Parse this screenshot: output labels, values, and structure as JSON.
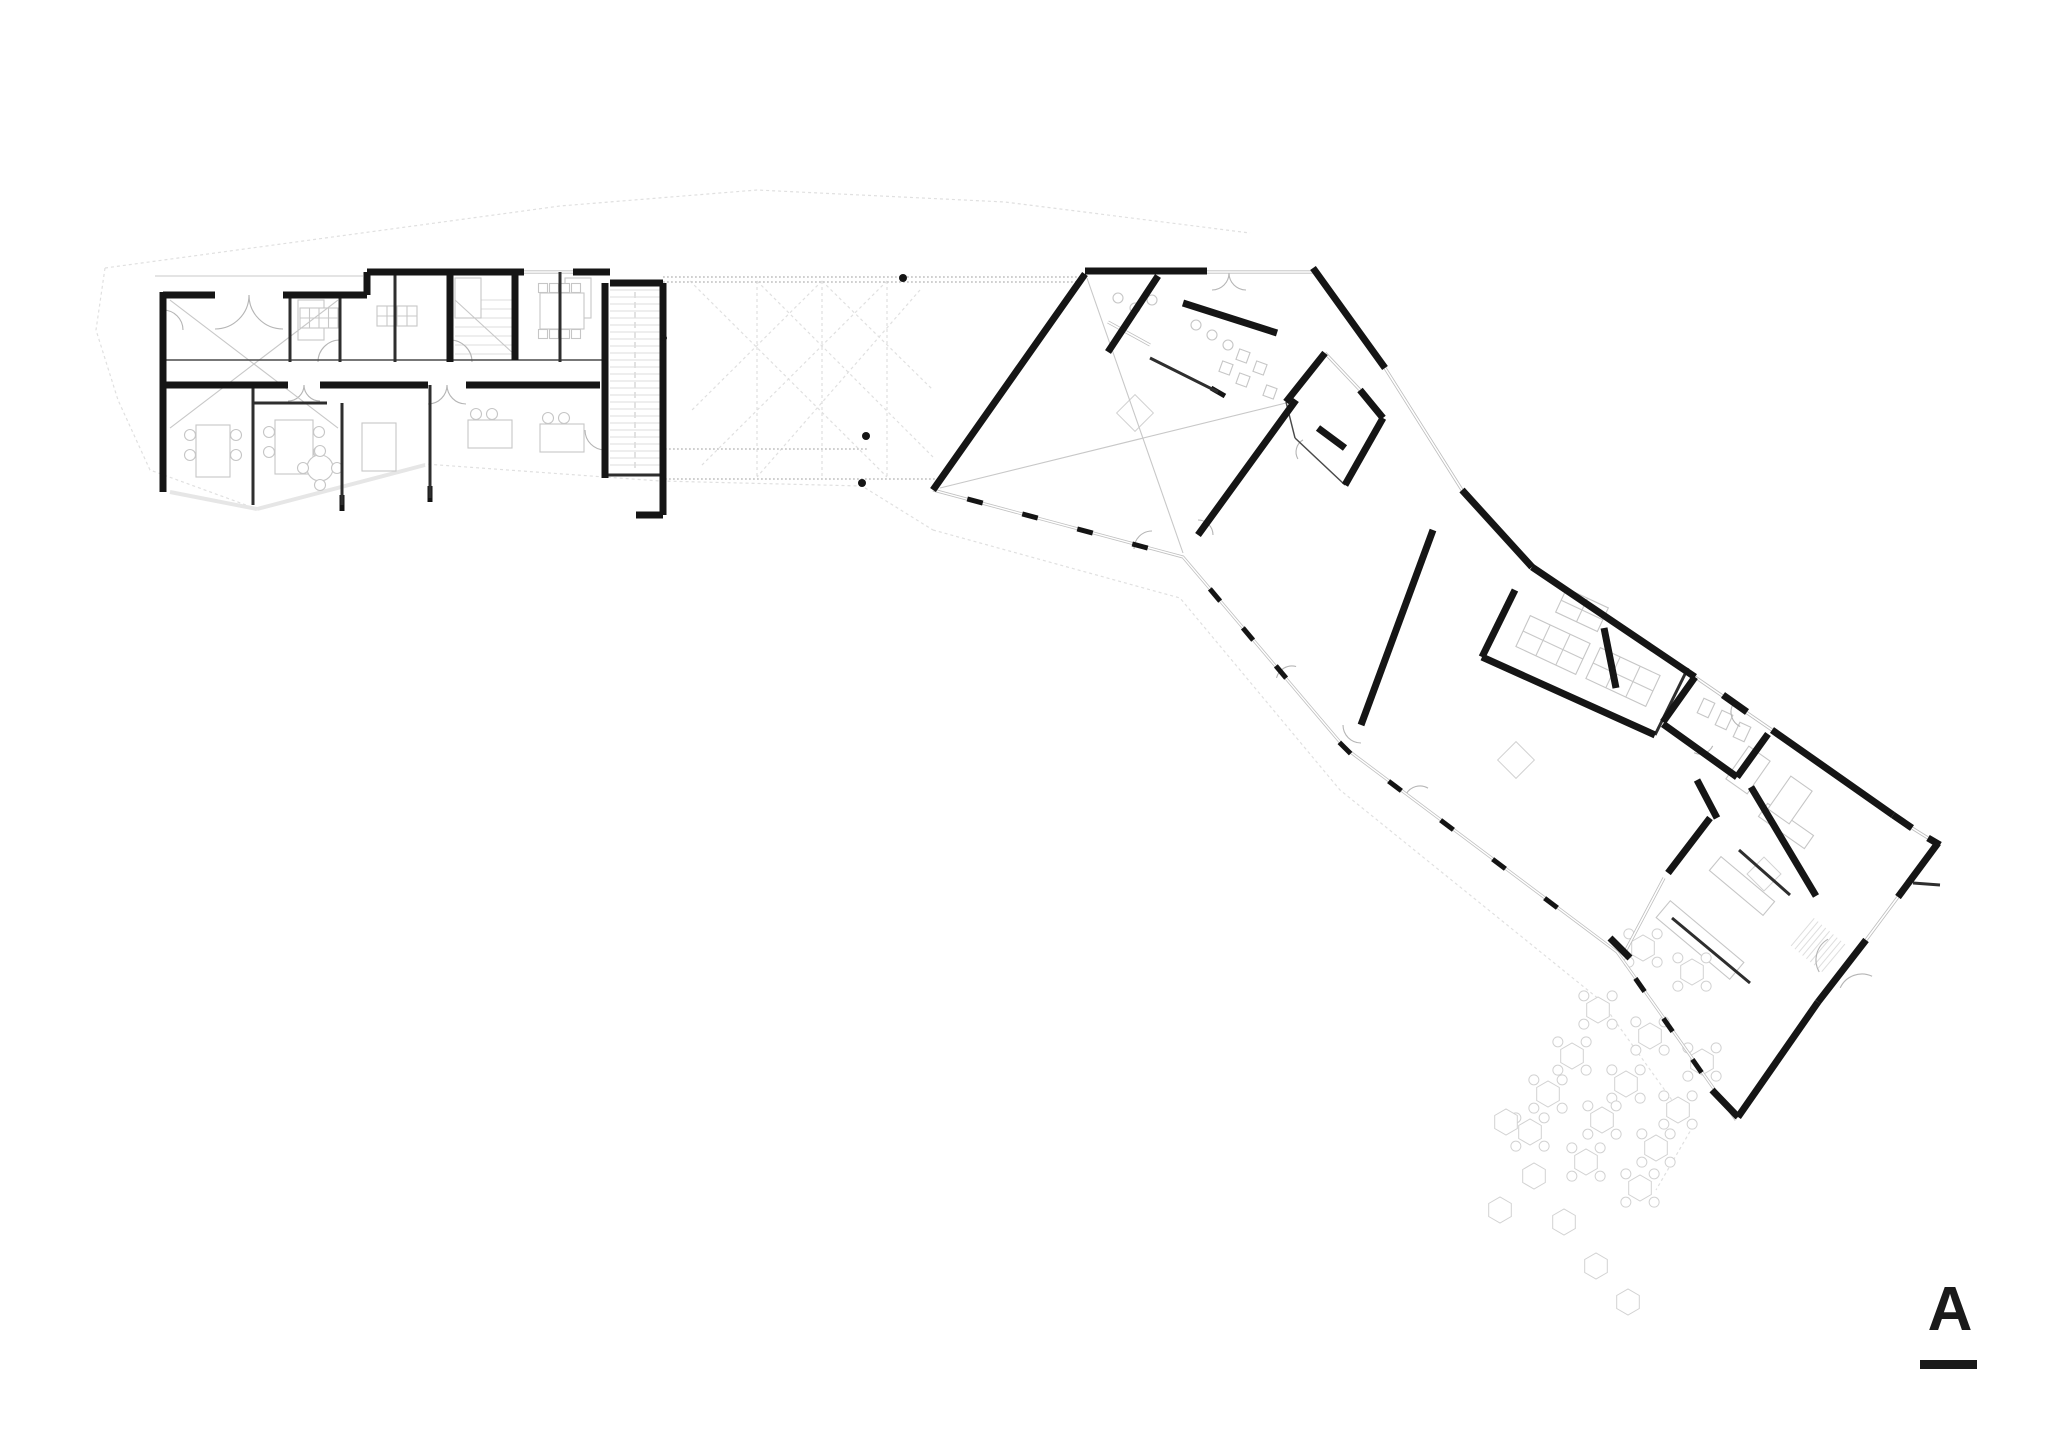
{
  "meta": {
    "type": "architectural-floor-plan",
    "sheet": "ground-floor-plan"
  },
  "marker": {
    "label": "A"
  },
  "palette": {
    "wall": "#151515",
    "medium": "#2e2e2e",
    "light": "#c8c8c8",
    "glass": "#bdbdbd",
    "marker": "#1a1a1a"
  },
  "plan": {
    "thick": [
      [
        163,
        295,
        215,
        295
      ],
      [
        283,
        295,
        367,
        295
      ],
      [
        367,
        272,
        367,
        295
      ],
      [
        367,
        272,
        524,
        272
      ],
      [
        573,
        272,
        610,
        272
      ],
      [
        610,
        283,
        663,
        283
      ],
      [
        163,
        292,
        163,
        492
      ],
      [
        163,
        385,
        288,
        385
      ],
      [
        320,
        385,
        428,
        385
      ],
      [
        466,
        385,
        600,
        385
      ],
      [
        605,
        283,
        605,
        478
      ],
      [
        663,
        283,
        663,
        515
      ],
      [
        663,
        515,
        636,
        515
      ],
      [
        515,
        272,
        515,
        360
      ],
      [
        450,
        272,
        450,
        362
      ],
      [
        1085,
        271,
        1207,
        271
      ],
      [
        1085,
        274,
        933,
        490
      ],
      [
        1313,
        268,
        1385,
        368
      ],
      [
        1462,
        490,
        1532,
        567
      ],
      [
        1532,
        567,
        1695,
        677
      ],
      [
        1695,
        677,
        1663,
        722
      ],
      [
        1158,
        276,
        1108,
        352
      ],
      [
        1183,
        303,
        1277,
        333
      ],
      [
        1296,
        400,
        1198,
        535
      ],
      [
        1433,
        530,
        1361,
        725
      ],
      [
        1325,
        353,
        1286,
        402
      ],
      [
        1360,
        390,
        1383,
        418
      ],
      [
        1383,
        418,
        1345,
        485
      ],
      [
        1318,
        428,
        1345,
        448
      ],
      [
        1610,
        938,
        1630,
        958
      ],
      [
        1482,
        657,
        1515,
        590
      ],
      [
        1482,
        657,
        1655,
        735
      ],
      [
        1604,
        628,
        1616,
        688
      ],
      [
        1663,
        724,
        1737,
        777
      ],
      [
        1737,
        777,
        1768,
        734
      ],
      [
        1772,
        730,
        1893,
        815
      ],
      [
        1723,
        695,
        1747,
        712
      ],
      [
        1893,
        815,
        1912,
        828
      ],
      [
        1928,
        838,
        1940,
        845
      ],
      [
        1938,
        843,
        1898,
        897
      ],
      [
        1866,
        940,
        1818,
        1002
      ],
      [
        1818,
        1002,
        1738,
        1117
      ],
      [
        1738,
        1117,
        1712,
        1090
      ],
      [
        1710,
        818,
        1668,
        873
      ],
      [
        1751,
        787,
        1816,
        896
      ],
      [
        1697,
        780,
        1717,
        818
      ]
    ],
    "medium": [
      [
        290,
        295,
        290,
        362
      ],
      [
        340,
        295,
        340,
        362
      ],
      [
        395,
        272,
        395,
        362
      ],
      [
        560,
        272,
        560,
        362
      ],
      [
        253,
        385,
        253,
        505
      ],
      [
        342,
        403,
        342,
        505
      ],
      [
        430,
        385,
        430,
        498
      ],
      [
        253,
        403,
        327,
        403
      ],
      [
        605,
        475,
        663,
        475
      ],
      [
        1150,
        358,
        1218,
        392
      ],
      [
        1655,
        735,
        1688,
        668
      ],
      [
        1672,
        918,
        1750,
        983
      ],
      [
        1913,
        883,
        1940,
        885
      ],
      [
        1739,
        850,
        1790,
        895
      ]
    ],
    "thin": [
      [
        1345,
        485,
        1295,
        438
      ],
      [
        1295,
        438,
        1286,
        402
      ],
      [
        163,
        360,
        605,
        360
      ]
    ],
    "light": [
      [
        170,
        300,
        338,
        428
      ],
      [
        338,
        300,
        170,
        428
      ],
      [
        940,
        488,
        1290,
        402
      ],
      [
        1087,
        278,
        1183,
        553
      ],
      [
        155,
        276,
        363,
        276
      ],
      [
        455,
        300,
        515,
        355
      ]
    ],
    "light3": [
      [
        170,
        492,
        257,
        509
      ],
      [
        257,
        509,
        425,
        465
      ]
    ],
    "dotband": [
      [
        663,
        277,
        1083,
        277
      ],
      [
        663,
        282,
        1083,
        282
      ],
      [
        665,
        449,
        868,
        449
      ],
      [
        665,
        479,
        935,
        479
      ]
    ],
    "dashpoly": [
      [
        [
          105,
          268
        ],
        [
          560,
          206
        ],
        [
          757,
          190
        ],
        [
          1005,
          202
        ],
        [
          1250,
          233
        ]
      ],
      [
        [
          105,
          268
        ],
        [
          96,
          330
        ],
        [
          118,
          400
        ],
        [
          150,
          470
        ],
        [
          257,
          509
        ],
        [
          425,
          464
        ],
        [
          660,
          481
        ],
        [
          862,
          486
        ],
        [
          933,
          530
        ]
      ],
      [
        [
          933,
          530
        ],
        [
          1180,
          598
        ],
        [
          1340,
          790
        ],
        [
          1600,
          1000
        ],
        [
          1692,
          1128
        ],
        [
          1656,
          1190
        ]
      ]
    ],
    "dashseg": [
      [
        757,
        281,
        757,
        477
      ],
      [
        822,
        281,
        822,
        477
      ],
      [
        887,
        281,
        887,
        477
      ],
      [
        690,
        281,
        887,
        477
      ],
      [
        757,
        281,
        933,
        457
      ],
      [
        822,
        281,
        933,
        390
      ],
      [
        822,
        281,
        690,
        412
      ],
      [
        887,
        281,
        700,
        467
      ],
      [
        920,
        290,
        757,
        477
      ]
    ],
    "cdash": [
      [
        635,
        292,
        635,
        468
      ]
    ],
    "glass": [
      [
        524,
        272,
        573,
        272
      ],
      [
        1207,
        272,
        1313,
        272
      ],
      [
        1385,
        368,
        1462,
        490
      ],
      [
        1695,
        677,
        1772,
        730
      ],
      [
        1898,
        897,
        1866,
        940
      ],
      [
        1912,
        828,
        1928,
        838
      ],
      [
        1664,
        878,
        1626,
        950
      ],
      [
        1108,
        322,
        1150,
        345
      ],
      [
        1325,
        353,
        1360,
        390
      ]
    ],
    "facade": {
      "pts": [
        [
          933,
          490
        ],
        [
          1183,
          557
        ],
        [
          1345,
          748
        ],
        [
          1617,
          952
        ],
        [
          1736,
          1120
        ]
      ]
    },
    "ticks": [
      [
        975,
        501,
        15
      ],
      [
        1030,
        516,
        15
      ],
      [
        1085,
        531,
        15
      ],
      [
        1140,
        546,
        15
      ],
      [
        1215,
        595,
        50
      ],
      [
        1248,
        634,
        50
      ],
      [
        1281,
        672,
        50
      ],
      [
        1345,
        748,
        45
      ],
      [
        1395,
        786,
        37
      ],
      [
        1447,
        825,
        37
      ],
      [
        1499,
        864,
        37
      ],
      [
        1551,
        903,
        37
      ],
      [
        1640,
        985,
        55
      ],
      [
        1668,
        1025,
        55
      ],
      [
        1697,
        1066,
        55
      ],
      [
        1218,
        392,
        30
      ],
      [
        342,
        503,
        90
      ],
      [
        430,
        494,
        90
      ]
    ],
    "dots": [
      [
        903,
        278,
        4
      ],
      [
        866,
        436,
        4
      ],
      [
        862,
        483,
        4
      ],
      [
        664,
        338,
        3
      ]
    ],
    "arcs": [
      [
        215,
        295,
        34,
        0,
        90
      ],
      [
        283,
        295,
        34,
        90,
        180
      ],
      [
        288,
        385,
        16,
        0,
        90
      ],
      [
        320,
        385,
        16,
        90,
        180
      ],
      [
        428,
        385,
        19,
        0,
        90
      ],
      [
        466,
        385,
        19,
        90,
        180
      ],
      [
        340,
        362,
        22,
        180,
        270
      ],
      [
        450,
        362,
        22,
        270,
        360
      ],
      [
        163,
        330,
        20,
        270,
        360
      ],
      [
        605,
        430,
        20,
        90,
        180
      ],
      [
        1212,
        273,
        17,
        0,
        90
      ],
      [
        1246,
        273,
        17,
        90,
        180
      ],
      [
        1361,
        725,
        18,
        90,
        180
      ],
      [
        1198,
        535,
        15,
        270,
        360
      ],
      [
        1152,
        549,
        18,
        180,
        270
      ],
      [
        1292,
        682,
        16,
        195,
        285
      ],
      [
        1420,
        802,
        16,
        210,
        300
      ],
      [
        1747,
        712,
        16,
        115,
        205
      ],
      [
        1840,
        960,
        24,
        150,
        240
      ],
      [
        1862,
        998,
        24,
        205,
        295
      ],
      [
        1310,
        452,
        14,
        150,
        240
      ],
      [
        1700,
        740,
        14,
        25,
        115
      ]
    ],
    "rects": [
      [
        311,
        320,
        26,
        40,
        0
      ],
      [
        468,
        298,
        26,
        40,
        0
      ],
      [
        578,
        298,
        26,
        40,
        0
      ],
      [
        562,
        311,
        44,
        36,
        0
      ],
      [
        213,
        451,
        34,
        52,
        0
      ],
      [
        294,
        447,
        38,
        54,
        0
      ],
      [
        379,
        447,
        34,
        48,
        0
      ],
      [
        490,
        434,
        44,
        28,
        0
      ],
      [
        562,
        438,
        44,
        28,
        0
      ],
      [
        1700,
        940,
        96,
        22,
        40
      ],
      [
        1742,
        886,
        70,
        18,
        40
      ],
      [
        1786,
        826,
        56,
        16,
        35
      ],
      [
        1748,
        770,
        26,
        40,
        35
      ],
      [
        1790,
        800,
        26,
        40,
        35
      ],
      [
        1706,
        708,
        12,
        16,
        25
      ],
      [
        1724,
        720,
        12,
        16,
        25
      ],
      [
        1742,
        732,
        12,
        16,
        25
      ]
    ],
    "grids": [
      [
        319,
        318,
        38,
        20,
        4,
        2,
        0
      ],
      [
        397,
        316,
        40,
        20,
        4,
        2,
        0
      ],
      [
        1553,
        645,
        66,
        34,
        3,
        2,
        25
      ],
      [
        1623,
        677,
        66,
        34,
        3,
        2,
        25
      ],
      [
        1582,
        610,
        46,
        26,
        2,
        2,
        25
      ]
    ],
    "circles": [
      [
        190,
        435,
        5.5
      ],
      [
        190,
        455,
        5.5
      ],
      [
        236,
        435,
        5.5
      ],
      [
        236,
        455,
        5.5
      ],
      [
        269,
        432,
        5.5
      ],
      [
        269,
        452,
        5.5
      ],
      [
        319,
        432,
        5.5
      ],
      [
        319,
        452,
        5.5
      ],
      [
        320,
        468,
        13
      ],
      [
        320,
        451,
        5.5
      ],
      [
        320,
        485,
        5.5
      ],
      [
        303,
        468,
        5.5
      ],
      [
        337,
        468,
        5.5
      ],
      [
        476,
        414,
        5.5
      ],
      [
        492,
        414,
        5.5
      ],
      [
        548,
        418,
        5.5
      ],
      [
        564,
        418,
        5.5
      ],
      [
        1118,
        298,
        5
      ],
      [
        1135,
        308,
        5
      ],
      [
        1152,
        300,
        5
      ],
      [
        1196,
        325,
        5
      ],
      [
        1212,
        335,
        5
      ],
      [
        1228,
        345,
        5
      ]
    ],
    "squares": [
      [
        543,
        288,
        9,
        0
      ],
      [
        554,
        288,
        9,
        0
      ],
      [
        565,
        288,
        9,
        0
      ],
      [
        576,
        288,
        9,
        0
      ],
      [
        543,
        334,
        9,
        0
      ],
      [
        554,
        334,
        9,
        0
      ],
      [
        565,
        334,
        9,
        0
      ],
      [
        576,
        334,
        9,
        0
      ],
      [
        1243,
        356,
        11,
        20
      ],
      [
        1260,
        368,
        11,
        20
      ],
      [
        1243,
        380,
        11,
        20
      ],
      [
        1226,
        368,
        11,
        20
      ],
      [
        1270,
        392,
        11,
        20
      ]
    ],
    "diamonds": [
      [
        1135,
        413,
        26
      ],
      [
        1516,
        760,
        26
      ],
      [
        1764,
        874,
        24
      ]
    ],
    "hex_tables": [
      [
        1643,
        948
      ],
      [
        1692,
        972
      ],
      [
        1598,
        1010
      ],
      [
        1650,
        1036
      ],
      [
        1702,
        1062
      ],
      [
        1572,
        1056
      ],
      [
        1626,
        1084
      ],
      [
        1678,
        1110
      ],
      [
        1548,
        1094
      ],
      [
        1602,
        1120
      ],
      [
        1656,
        1148
      ],
      [
        1530,
        1132
      ],
      [
        1586,
        1162
      ],
      [
        1640,
        1188
      ]
    ],
    "hex_plain": [
      [
        1506,
        1122
      ],
      [
        1534,
        1176
      ],
      [
        1564,
        1222
      ],
      [
        1596,
        1266
      ],
      [
        1628,
        1302
      ],
      [
        1500,
        1210
      ]
    ],
    "hatches": [
      [
        610,
        290,
        50,
        180,
        7,
        0
      ],
      [
        455,
        300,
        60,
        55,
        9,
        0
      ],
      [
        1800,
        925,
        36,
        40,
        5,
        -50
      ]
    ],
    "marker_underline": [
      1920,
      1360,
      57,
      9
    ],
    "marker_pos": {
      "x": 1950,
      "y": 1330
    }
  }
}
